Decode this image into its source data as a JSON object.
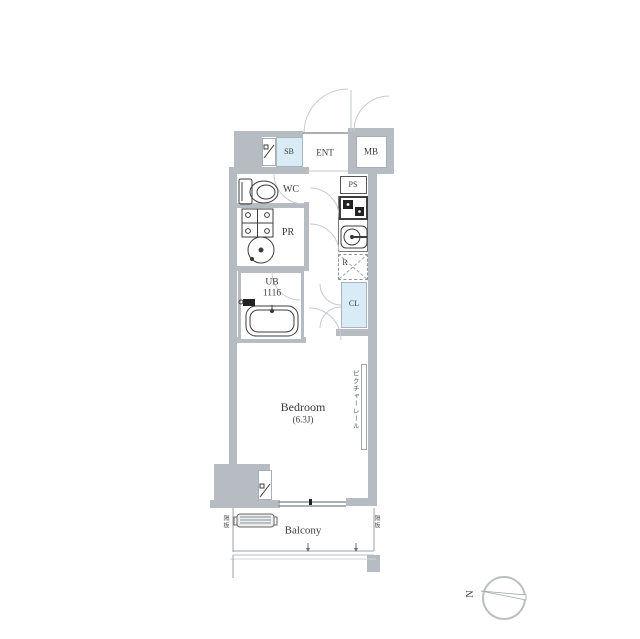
{
  "colors": {
    "wall": "#b6bcc2",
    "highlight": "#d9ebf4",
    "line": "#9aa3ab",
    "arc": "#c6cbd1",
    "fixture": "#3c3c3c",
    "text": "#3a3a3c"
  },
  "rooms": {
    "sb": "SB",
    "ent": "ENT",
    "mb": "MB",
    "wc": "WC",
    "ps": "PS",
    "pr": "PR",
    "r": "R",
    "ub_line1": "UB",
    "ub_line2": "1116",
    "cl": "CL",
    "bedroom_name": "Bedroom",
    "bedroom_size": "(6.3J)",
    "balcony": "Balcony"
  },
  "annotations": {
    "picture_rail": "ピクチャーレール",
    "partition_left": "隔板",
    "partition_right": "隔板",
    "compass_north": "N"
  }
}
